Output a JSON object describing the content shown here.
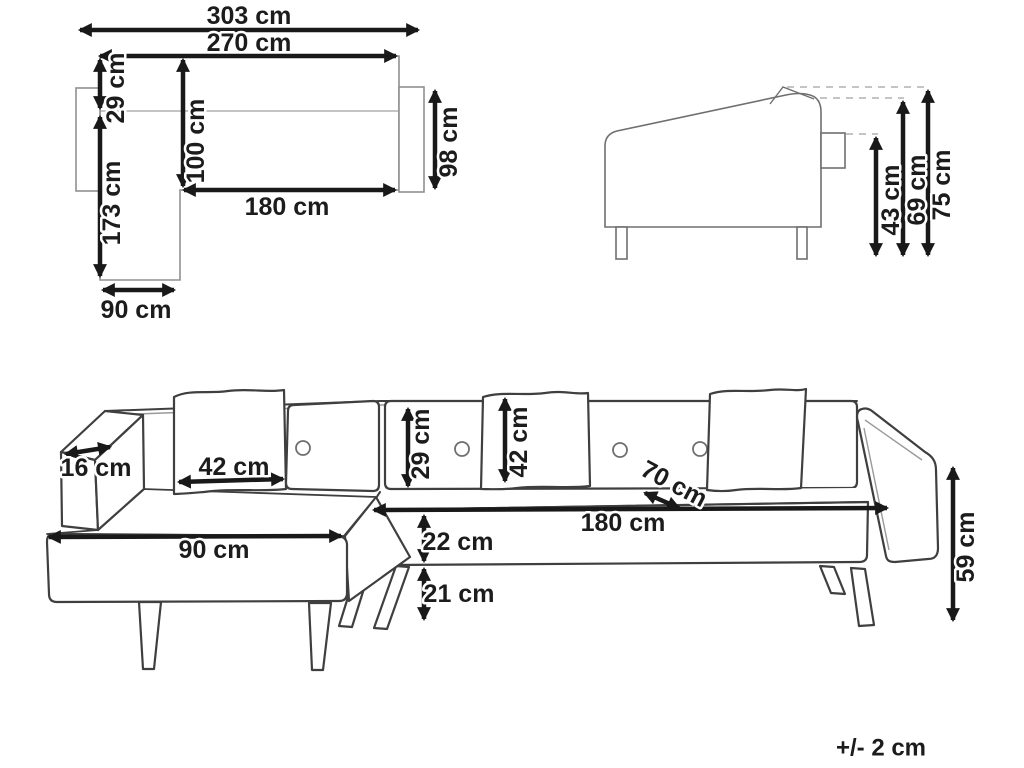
{
  "diagram": {
    "tolerance_note": "+/- 2 cm",
    "top_view": {
      "total_width": "303 cm",
      "body_width": "270 cm",
      "backrest_depth": "29 cm",
      "sofa_depth": "100 cm",
      "chaise_length": "173 cm",
      "right_side_depth": "98 cm",
      "seat_width": "180 cm",
      "chaise_width": "90 cm"
    },
    "side_view": {
      "seat_height": "43 cm",
      "armrest_height": "69 cm",
      "total_height": "75 cm"
    },
    "front_view": {
      "armrest_width": "16 cm",
      "cushion_width": "42 cm",
      "chaise_width": "90 cm",
      "backrest_above_seat": "29 cm",
      "cushion_height": "42 cm",
      "seat_depth": "70 cm",
      "seat_width": "180 cm",
      "seat_front_height": "22 cm",
      "leg_height": "21 cm",
      "armrest_side_height": "59 cm"
    }
  }
}
